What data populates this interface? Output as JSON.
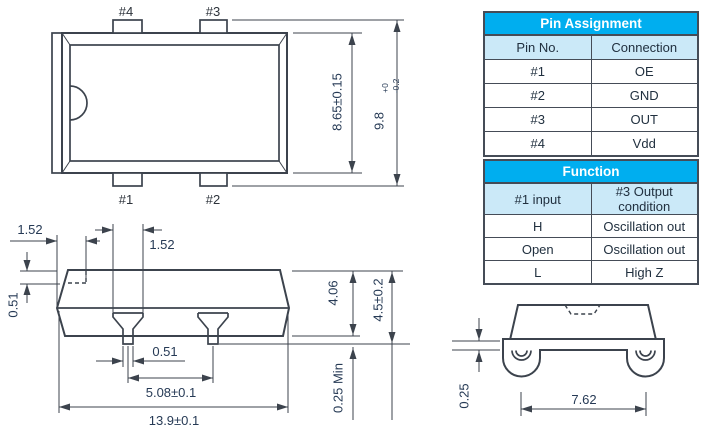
{
  "drawing": {
    "top_view": {
      "pin4": "#4",
      "pin3": "#3",
      "pin1": "#1",
      "pin2": "#2",
      "body_height": "8.65±0.15",
      "overall_height": "9.8",
      "tol_plus": "+0",
      "tol_minus": "-0.2"
    },
    "side_view": {
      "lid_inset": "1.52",
      "pin_top_width": "1.52",
      "lid_thickness": "0.51",
      "pin_tip_width": "0.51",
      "pin_pitch": "5.08±0.1",
      "overall_length": "13.9±0.1",
      "body_height": "4.06",
      "overall_height": "4.5±0.2",
      "standoff": "0.25 Min"
    },
    "end_view": {
      "lead_thickness": "0.25",
      "lead_span": "7.62"
    }
  },
  "tables": {
    "pin_assignment": {
      "title": "Pin Assignment",
      "headers": [
        "Pin No.",
        "Connection"
      ],
      "rows": [
        [
          "#1",
          "OE"
        ],
        [
          "#2",
          "GND"
        ],
        [
          "#3",
          "OUT"
        ],
        [
          "#4",
          "Vdd"
        ]
      ]
    },
    "function": {
      "title": "Function",
      "headers": [
        "#1 input",
        "#3 Output condition"
      ],
      "rows": [
        [
          "H",
          "Oscillation out"
        ],
        [
          "Open",
          "Oscillation out"
        ],
        [
          "L",
          "High Z"
        ]
      ]
    }
  },
  "colors": {
    "header_bg": "#00AEEF",
    "subheader_bg": "#CBE9F8",
    "line_ink": "#3c434d",
    "dim_text": "#263a55"
  }
}
